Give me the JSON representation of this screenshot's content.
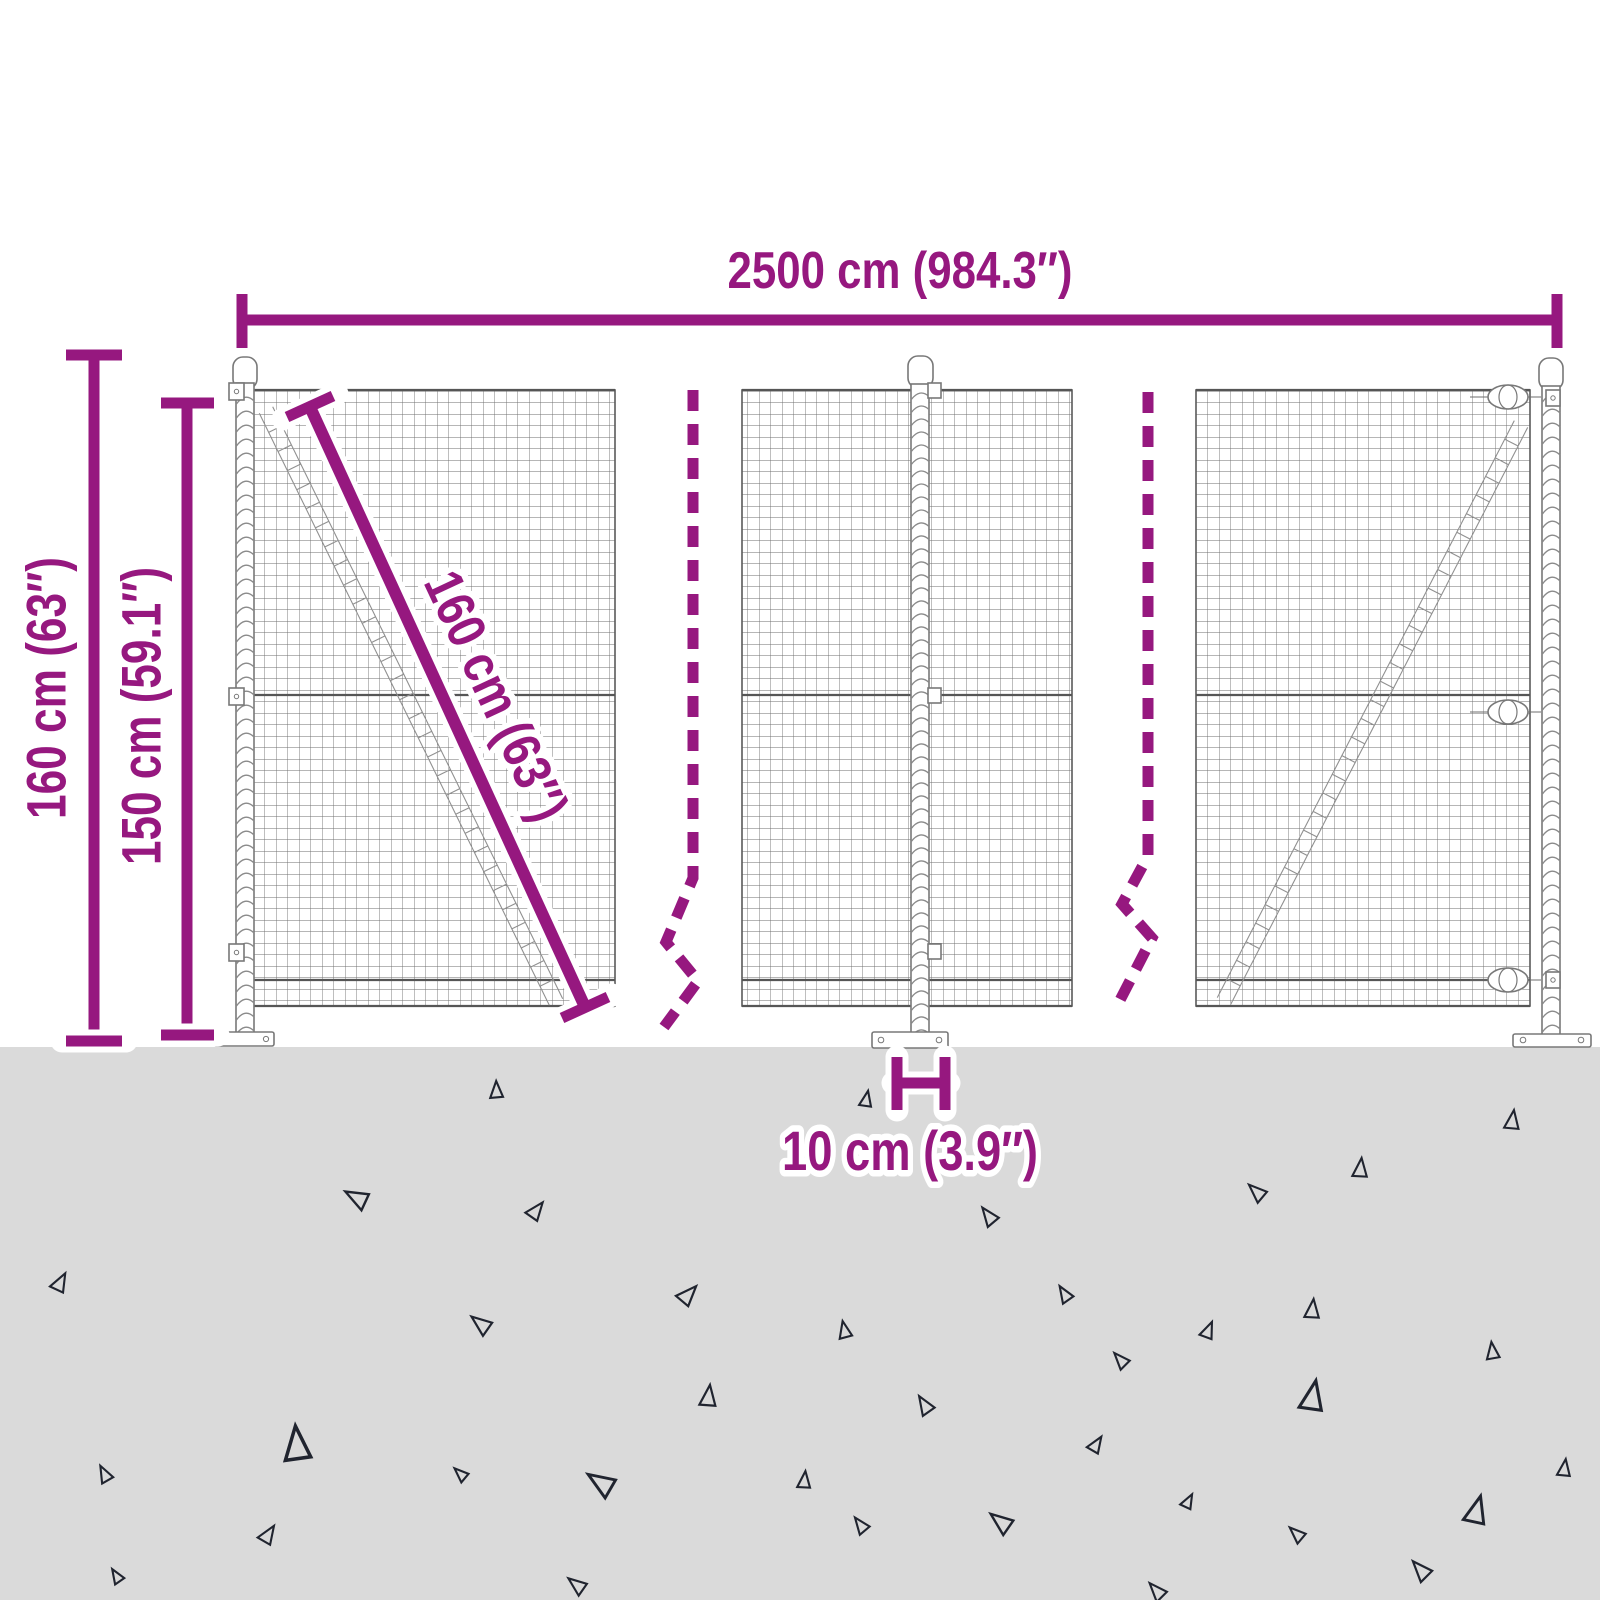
{
  "diagram": {
    "type": "product-dimension-diagram",
    "subject": "wire mesh fence with posts and ground anchoring",
    "labels": {
      "width_top": "2500 cm (984.3″)",
      "height_total": "160 cm (63″)",
      "height_mesh": "150 cm (59.1″)",
      "diagonal": "160 cm (63″)",
      "post_ground_depth": "10 cm (3.9″)"
    },
    "colors": {
      "accent": "#96187F",
      "ground": "#DADADA",
      "triangle_outline": "#20242F",
      "fence_line": "#5E5E5E",
      "background": "#FFFFFF"
    },
    "ground": {
      "triangles": [
        {
          "x": 496,
          "y": 1090,
          "s": 16,
          "r": -5
        },
        {
          "x": 866,
          "y": 1099,
          "s": 15,
          "r": 8
        },
        {
          "x": 1512,
          "y": 1120,
          "s": 18,
          "r": 5
        },
        {
          "x": 1360,
          "y": 1168,
          "s": 18,
          "r": 3
        },
        {
          "x": 356,
          "y": 1198,
          "s": 22,
          "r": -65
        },
        {
          "x": 1256,
          "y": 1192,
          "s": 18,
          "r": -50
        },
        {
          "x": 536,
          "y": 1210,
          "s": 18,
          "r": 35
        },
        {
          "x": 988,
          "y": 1216,
          "s": 18,
          "r": -40
        },
        {
          "x": 60,
          "y": 1282,
          "s": 18,
          "r": 25
        },
        {
          "x": 688,
          "y": 1294,
          "s": 20,
          "r": 40
        },
        {
          "x": 1064,
          "y": 1294,
          "s": 16,
          "r": -35
        },
        {
          "x": 1312,
          "y": 1309,
          "s": 18,
          "r": 3
        },
        {
          "x": 480,
          "y": 1324,
          "s": 20,
          "r": -55
        },
        {
          "x": 1208,
          "y": 1330,
          "s": 16,
          "r": 20
        },
        {
          "x": 844,
          "y": 1330,
          "s": 16,
          "r": -15
        },
        {
          "x": 1492,
          "y": 1351,
          "s": 16,
          "r": -10
        },
        {
          "x": 1120,
          "y": 1360,
          "s": 16,
          "r": -45
        },
        {
          "x": 708,
          "y": 1396,
          "s": 20,
          "r": 4
        },
        {
          "x": 1312,
          "y": 1396,
          "s": 28,
          "r": 8
        },
        {
          "x": 924,
          "y": 1405,
          "s": 18,
          "r": -35
        },
        {
          "x": 296,
          "y": 1444,
          "s": 32,
          "r": -8
        },
        {
          "x": 1096,
          "y": 1444,
          "s": 16,
          "r": 30
        },
        {
          "x": 104,
          "y": 1474,
          "s": 16,
          "r": -30
        },
        {
          "x": 460,
          "y": 1474,
          "s": 14,
          "r": -50
        },
        {
          "x": 804,
          "y": 1480,
          "s": 16,
          "r": 3
        },
        {
          "x": 1564,
          "y": 1468,
          "s": 16,
          "r": 5
        },
        {
          "x": 600,
          "y": 1483,
          "s": 26,
          "r": -60
        },
        {
          "x": 1188,
          "y": 1501,
          "s": 14,
          "r": 25
        },
        {
          "x": 1476,
          "y": 1510,
          "s": 26,
          "r": 12
        },
        {
          "x": 268,
          "y": 1534,
          "s": 18,
          "r": 30
        },
        {
          "x": 860,
          "y": 1525,
          "s": 16,
          "r": -40
        },
        {
          "x": 1000,
          "y": 1522,
          "s": 22,
          "r": -55
        },
        {
          "x": 1296,
          "y": 1534,
          "s": 16,
          "r": -50
        },
        {
          "x": 116,
          "y": 1576,
          "s": 14,
          "r": -35
        },
        {
          "x": 1420,
          "y": 1570,
          "s": 20,
          "r": -45
        },
        {
          "x": 576,
          "y": 1585,
          "s": 18,
          "r": -55
        },
        {
          "x": 1156,
          "y": 1591,
          "s": 18,
          "r": -45
        }
      ]
    }
  }
}
